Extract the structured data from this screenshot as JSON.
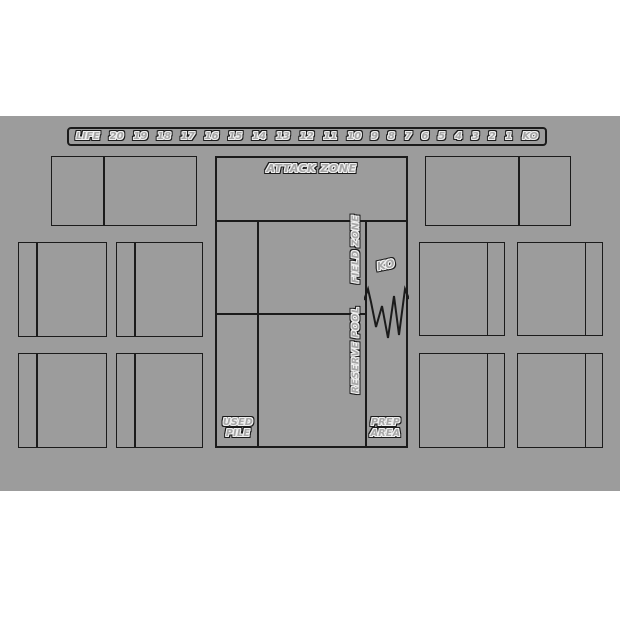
{
  "page": {
    "background_color": "#ffffff"
  },
  "mat": {
    "bg_color": "#9c9c9c",
    "line_color": "#1b1b1b",
    "life_track": {
      "label": "LIFE",
      "values": [
        "20",
        "19",
        "18",
        "17",
        "16",
        "15",
        "14",
        "13",
        "12",
        "11",
        "10",
        "9",
        "8",
        "7",
        "6",
        "5",
        "4",
        "3",
        "2",
        "1",
        "KO"
      ]
    },
    "zones": {
      "attack_zone": "ATTACK ZONE",
      "field_zone": "FIELD ZONE",
      "reserve_pool": "RESERVE POOL",
      "ko": "KO",
      "used_pile": "USED PILE",
      "prep_area": "PREP AREA"
    }
  }
}
